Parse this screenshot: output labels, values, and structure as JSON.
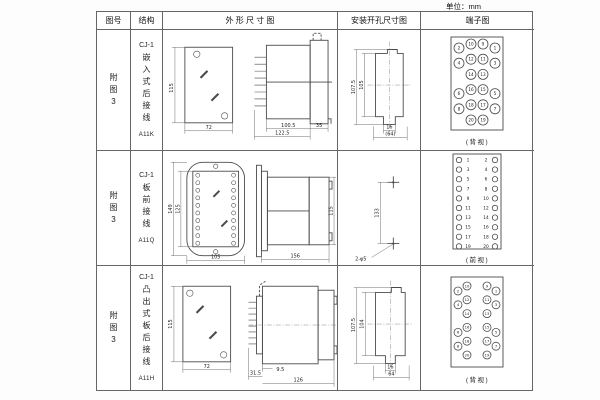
{
  "unit_label": "单位：mm",
  "header": {
    "fig": "图号",
    "struct": "结构",
    "outline": "外 形 尺 寸 图",
    "install": "安装开孔尺寸图",
    "terminal": "端子图"
  },
  "rows": [
    {
      "fig": "附图3",
      "model": "CJ-1",
      "name": "嵌入式后接线",
      "code": "A11K",
      "outline": {
        "h": "115",
        "w": "72",
        "l1": "100.5",
        "l2": "122.5",
        "l3": "35"
      },
      "install": {
        "v1": "107.5",
        "v2": "105",
        "h1": "16",
        "h2": "(64)"
      },
      "terminal": {
        "caption": "(背视)",
        "layout": "staggered",
        "rows": [
          [
            2,
            10,
            9,
            1
          ],
          [
            4,
            12,
            11,
            3
          ],
          [
            null,
            14,
            13,
            null
          ],
          [
            6,
            16,
            15,
            5
          ],
          [
            8,
            18,
            17,
            7
          ],
          [
            null,
            20,
            19,
            null
          ]
        ]
      }
    },
    {
      "fig": "附图3",
      "model": "CJ-1",
      "name": "板前接线",
      "code": "A11Q",
      "outline": {
        "h1": "149",
        "h2": "125",
        "w": "105",
        "l": "156",
        "side_h": "115"
      },
      "install": {
        "v": "133",
        "hole": "2-φ5"
      },
      "terminal": {
        "caption": "(前视)",
        "layout": "twocol",
        "pairs": [
          [
            1,
            2
          ],
          [
            3,
            4
          ],
          [
            5,
            6
          ],
          [
            7,
            8
          ],
          [
            9,
            10
          ],
          [
            11,
            12
          ],
          [
            13,
            14
          ],
          [
            15,
            16
          ],
          [
            17,
            18
          ],
          [
            19,
            20
          ]
        ]
      }
    },
    {
      "fig": "附图3",
      "model": "CJ-1",
      "name": "凸出式板后接线",
      "code": "A11H",
      "outline": {
        "h": "115",
        "w": "72",
        "l1": "9.5",
        "l2": "31.5",
        "l3": "126"
      },
      "install": {
        "v1": "107.5",
        "v2": "104",
        "h1": "16",
        "h2": "64"
      },
      "terminal": {
        "caption": "(背视)",
        "layout": "split",
        "rows": [
          [
            2,
            10,
            9,
            1
          ],
          [
            4,
            12,
            11,
            3
          ],
          [
            null,
            14,
            13,
            null
          ],
          [
            6,
            16,
            15,
            5
          ],
          [
            8,
            18,
            17,
            7
          ],
          [
            null,
            20,
            19,
            null
          ]
        ]
      }
    }
  ]
}
